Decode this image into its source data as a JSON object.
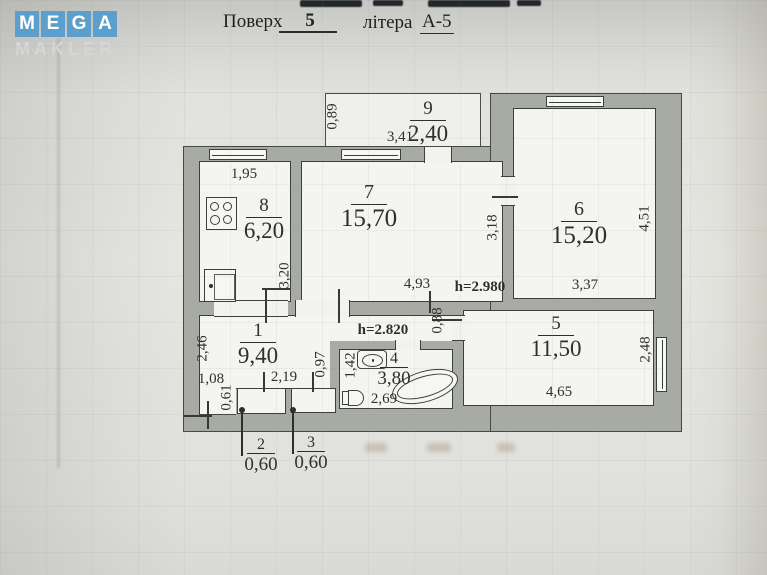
{
  "watermark": {
    "tiles": [
      "M",
      "E",
      "G",
      "A"
    ],
    "word": "MAKLER",
    "tile_color": "#5d9fcc"
  },
  "header": {
    "floor_label": "Поверх",
    "floor_value": "5",
    "letter_label": "літера",
    "letter_value": "А-5"
  },
  "rooms": {
    "r1": {
      "num": "1",
      "area": "9,40"
    },
    "r2": {
      "num": "2",
      "area": "0,60"
    },
    "r3": {
      "num": "3",
      "area": "0,60"
    },
    "r4": {
      "num": "4",
      "area": "3,80"
    },
    "r5": {
      "num": "5",
      "area": "11,50"
    },
    "r6": {
      "num": "6",
      "area": "15,20"
    },
    "r7": {
      "num": "7",
      "area": "15,70"
    },
    "r8": {
      "num": "8",
      "area": "6,20"
    },
    "r9": {
      "num": "9",
      "area": "2,40"
    }
  },
  "heights": {
    "room7": "h=2.980",
    "hall": "h=2.820"
  },
  "dims": {
    "balcony_depth": "0,89",
    "balcony_width": "3,41",
    "kitchen_top": "1,95",
    "kitchen_right": "3,20",
    "room7_bottom": "4,93",
    "room7_right": "3,18",
    "room6_right": "4,51",
    "room6_bottom": "3,37",
    "room5_right": "2,48",
    "room5_bottom": "4,65",
    "room5_entry": "0,88",
    "hall_left": "2,46",
    "hall_left2": "1,08",
    "hall_left3": "0,61",
    "hall_mid": "2,19",
    "hall_right": "0,97",
    "bath_left": "1,42",
    "bath_bottom": "2,69"
  },
  "colors": {
    "wall": "#a8aba3",
    "logo_tile": "#5d9fcc"
  }
}
